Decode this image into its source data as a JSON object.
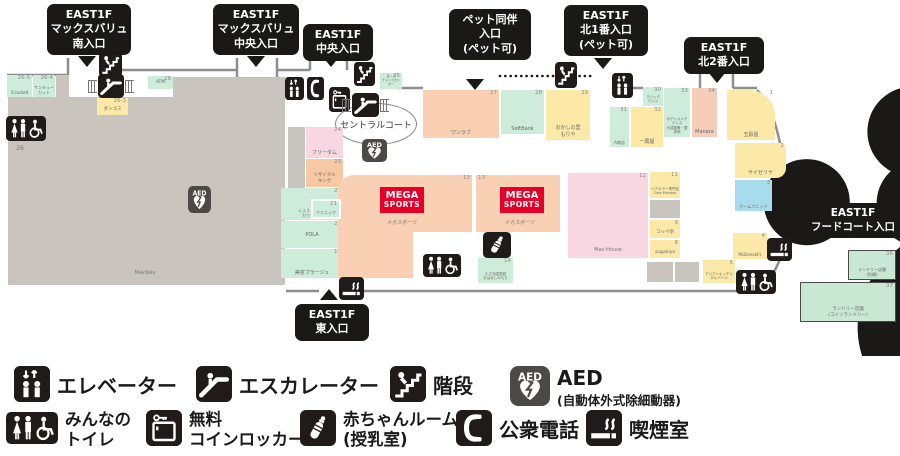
{
  "map": {
    "central_court": "セントラルコート",
    "logos": {
      "maxvalu": {
        "title": "MaxValu",
        "sub": "スーパーマーケット"
      },
      "mega": {
        "line1": "MEGA",
        "line2": "SPORTS"
      },
      "machouse": "Mac-House"
    },
    "entrances": [
      {
        "lines": [
          "EAST1F",
          "マックスバリュ",
          "南入口"
        ],
        "x": 47,
        "y": 4,
        "w": 84,
        "arrow": {
          "d": "down",
          "x": 78,
          "y": 56
        }
      },
      {
        "lines": [
          "EAST1F",
          "マックスバリュ",
          "中央入口"
        ],
        "x": 213,
        "y": 4,
        "w": 86,
        "arrow": {
          "d": "down",
          "x": 247,
          "y": 56
        }
      },
      {
        "lines": [
          "EAST1F",
          "中央入口"
        ],
        "x": 303,
        "y": 24,
        "w": 70,
        "arrow": {
          "d": "down",
          "x": 322,
          "y": 56
        }
      },
      {
        "lines": [
          "ペット同伴",
          "入口",
          "(ペット可)"
        ],
        "x": 449,
        "y": 9,
        "w": 82,
        "arrow": {
          "d": "down",
          "x": 466,
          "y": 79
        }
      },
      {
        "lines": [
          "EAST1F",
          "北1番入口",
          "(ペット可)"
        ],
        "x": 564,
        "y": 5,
        "w": 84,
        "arrow": {
          "d": "down",
          "x": 594,
          "y": 58
        }
      },
      {
        "lines": [
          "EAST1F",
          "北2番入口"
        ],
        "x": 684,
        "y": 37,
        "w": 80,
        "arrow": {
          "d": "down",
          "x": 708,
          "y": 72
        }
      },
      {
        "lines": [
          "EAST1F",
          "フードコート入口"
        ],
        "x": 806,
        "y": 203,
        "w": 94,
        "fs": 10.5,
        "arrow": {
          "d": "left",
          "x": 793,
          "y": 215
        }
      },
      {
        "lines": [
          "EAST1F",
          "東入口"
        ],
        "x": 295,
        "y": 304,
        "w": 74,
        "arrow": {
          "d": "up",
          "x": 320,
          "y": 289
        }
      }
    ],
    "shops": [
      {
        "x": 8,
        "y": 97,
        "w": 277,
        "h": 188,
        "c": "#cac4be"
      },
      {
        "x": 173,
        "y": 77,
        "w": 112,
        "h": 20,
        "c": "#cac4be"
      },
      {
        "x": 288,
        "y": 127,
        "w": 17,
        "h": 61,
        "c": "#cac4be"
      },
      {
        "x": 7,
        "y": 75,
        "w": 25,
        "h": 22,
        "c": "#cdecd9",
        "num": "26-5",
        "name": "iCracked",
        "fs": 4
      },
      {
        "x": 33,
        "y": 75,
        "w": 22,
        "h": 22,
        "c": "#cdecd9",
        "num": "26-4",
        "name": "サンキュー\nカット",
        "fs": 4
      },
      {
        "x": 56,
        "y": 75,
        "w": 13,
        "h": 25,
        "c": "#cac4be"
      },
      {
        "x": 97,
        "y": 98,
        "w": 31,
        "h": 17,
        "c": "#fce9a8",
        "num": "26-3",
        "name": "ダンゴス",
        "fs": 4.5
      },
      {
        "x": 148,
        "y": 76,
        "w": 25,
        "h": 13,
        "c": "#cdecd9",
        "num": "26",
        "name": "ATM",
        "cen": true,
        "fs": 4.5
      },
      {
        "x": 306,
        "y": 127,
        "w": 37,
        "h": 31,
        "c": "#f8d7e3",
        "num": "24",
        "name": "フリーダム"
      },
      {
        "x": 306,
        "y": 159,
        "w": 37,
        "h": 28,
        "c": "#f7c8a2",
        "num": "23",
        "name": "リサイクル\nキング",
        "fs": 4.5
      },
      {
        "x": 281,
        "y": 188,
        "w": 62,
        "h": 32,
        "c": "#cdecd9",
        "num": "22",
        "name": "くふうイエナカ\nカウンター",
        "fs": 4
      },
      {
        "x": 311,
        "y": 199,
        "w": 30,
        "h": 20,
        "c": "#cdecd9",
        "num": "21",
        "name": "クリニック",
        "fs": 4,
        "inset": true
      },
      {
        "x": 281,
        "y": 221,
        "w": 62,
        "h": 27,
        "c": "#cdecd9",
        "num": "20",
        "name": "POLA",
        "cen": true
      },
      {
        "x": 281,
        "y": 249,
        "w": 62,
        "h": 29,
        "c": "#cdecd9",
        "num": "19",
        "name": "美容プラージュ"
      },
      {
        "x": 423,
        "y": 90,
        "w": 76,
        "h": 48,
        "c": "#f9d0b4",
        "num": "27",
        "name": "ワンラブ"
      },
      {
        "x": 501,
        "y": 90,
        "w": 43,
        "h": 44,
        "c": "#cdecd9",
        "num": "28",
        "name": "SoftBank"
      },
      {
        "x": 546,
        "y": 90,
        "w": 44,
        "h": 50,
        "c": "#fce9a8",
        "num": "29",
        "name": "おかしの里\nもりや"
      },
      {
        "x": 643,
        "y": 87,
        "w": 20,
        "h": 19,
        "c": "#cdecd9",
        "num": "30",
        "name": "マジック\nミシン",
        "fs": 3.5
      },
      {
        "x": 610,
        "y": 107,
        "w": 19,
        "h": 40,
        "c": "#cdecd9",
        "num": "31",
        "name": "A商店",
        "fs": 4
      },
      {
        "x": 631,
        "y": 107,
        "w": 32,
        "h": 40,
        "c": "#fce9a8",
        "num": "32",
        "name": "一蔵屋"
      },
      {
        "x": 664,
        "y": 88,
        "w": 26,
        "h": 49,
        "c": "#cdecd9",
        "num": "33",
        "name": "ボディメンテナンス\n大成整骨・整体院",
        "fs": 3.5
      },
      {
        "x": 692,
        "y": 88,
        "w": 25,
        "h": 49,
        "c": "#f5cdb9",
        "num": "34",
        "name": "Manara"
      },
      {
        "x": 727,
        "y": 90,
        "w": 48,
        "h": 50,
        "c": "#fce9a8",
        "num": "1",
        "name": "五穀屋",
        "r": "0 26px 0 0"
      },
      {
        "x": 735,
        "y": 143,
        "w": 51,
        "h": 35,
        "c": "#fce9a8",
        "num": "2",
        "name": "サイゼリヤ",
        "r": "0 6px 10px 0"
      },
      {
        "x": 735,
        "y": 180,
        "w": 37,
        "h": 31,
        "c": "#a8dcec",
        "num": "3",
        "name": "ゲームパニック",
        "fs": 4
      },
      {
        "x": 733,
        "y": 233,
        "w": 34,
        "h": 26,
        "c": "#fce9a8",
        "num": "4",
        "name": "McDonald's",
        "fs": 4
      },
      {
        "x": 703,
        "y": 260,
        "w": 32,
        "h": 23,
        "c": "#fce9a8",
        "num": "5",
        "name": "アジアンキッチン\nダルバール",
        "fs": 3.5
      },
      {
        "x": 650,
        "y": 172,
        "w": 30,
        "h": 26,
        "c": "#fce9a8",
        "num": "11",
        "name": "ヘアカラー専門店\nCinq Minutes",
        "fs": 3.5
      },
      {
        "x": 650,
        "y": 200,
        "w": 30,
        "h": 18,
        "c": "#cac4be"
      },
      {
        "x": 650,
        "y": 220,
        "w": 30,
        "h": 18,
        "c": "#fce9a8",
        "num": "9",
        "name": "コッペ亭",
        "fs": 4.5
      },
      {
        "x": 650,
        "y": 240,
        "w": 30,
        "h": 18,
        "c": "#fce9a8",
        "num": "8",
        "name": "sugakiya",
        "fs": 4.5
      },
      {
        "x": 647,
        "y": 262,
        "w": 26,
        "h": 20,
        "c": "#cac4be"
      },
      {
        "x": 675,
        "y": 262,
        "w": 24,
        "h": 20,
        "c": "#cac4be"
      },
      {
        "x": 338,
        "y": 175,
        "w": 134,
        "h": 57,
        "c": "#f9d0b4",
        "num": "13",
        "r": "16px 0 0 0"
      },
      {
        "x": 338,
        "y": 232,
        "w": 75,
        "h": 46,
        "c": "#f9d0b4"
      },
      {
        "x": 476,
        "y": 175,
        "w": 84,
        "h": 57,
        "c": "#f9d0b4",
        "num": "13",
        "numTL": true
      },
      {
        "x": 568,
        "y": 173,
        "w": 80,
        "h": 85,
        "c": "#f8d7e3",
        "num": "12"
      },
      {
        "x": 478,
        "y": 258,
        "w": 35,
        "h": 25,
        "c": "#cdecd9",
        "num": "14",
        "name": "小さな図書館\nおはなしのもり",
        "fs": 3.5
      },
      {
        "x": 848,
        "y": 250,
        "w": 48,
        "h": 30,
        "c": "#c9e8d4",
        "num": "36",
        "name": "ランドリー店舗\n(別棟)",
        "fs": 4,
        "bd": true
      },
      {
        "x": 800,
        "y": 282,
        "w": 96,
        "h": 40,
        "c": "#c9e8d4",
        "num": "37",
        "name": "ランドリー店舗\n(コインランドリー)",
        "fs": 4.5,
        "bd": true
      },
      {
        "x": 380,
        "y": 73,
        "w": 22,
        "h": 16,
        "c": "#cdecd9",
        "num": "35",
        "name": "宝くじ\nチャンスセンター",
        "fs": 3
      }
    ],
    "texts": [
      {
        "t": "メガスポーツ",
        "x": 372,
        "y": 221,
        "w": 60,
        "s": 5
      },
      {
        "t": "メガスポーツ",
        "x": 490,
        "y": 221,
        "w": 60,
        "s": 5
      },
      {
        "t": "Mac-House",
        "x": 583,
        "y": 248,
        "w": 50,
        "s": 5
      },
      {
        "t": "MaxValu",
        "x": 125,
        "y": 271,
        "w": 40,
        "s": 5
      },
      {
        "t": "26",
        "x": 10,
        "y": 146,
        "w": 20,
        "s": 6
      }
    ],
    "icons": [
      {
        "t": "stairs",
        "x": 99,
        "y": 52,
        "w": 23,
        "h": 25
      },
      {
        "t": "esc",
        "x": 98,
        "y": 74,
        "w": 26,
        "h": 24,
        "comb": true
      },
      {
        "t": "stairs",
        "x": 354,
        "y": 62,
        "w": 21,
        "h": 24
      },
      {
        "t": "elev",
        "x": 285,
        "y": 77,
        "w": 19,
        "h": 23
      },
      {
        "t": "phone",
        "x": 307,
        "y": 77,
        "w": 17,
        "h": 23
      },
      {
        "t": "locker",
        "x": 329,
        "y": 87,
        "w": 21,
        "h": 25
      },
      {
        "t": "esc",
        "x": 352,
        "y": 93,
        "w": 27,
        "h": 24,
        "comb": true
      },
      {
        "t": "aed",
        "x": 362,
        "y": 139,
        "w": 25,
        "h": 23
      },
      {
        "t": "aed",
        "x": 188,
        "y": 186,
        "w": 23,
        "h": 27
      },
      {
        "t": "toilet",
        "x": 6,
        "y": 116,
        "w": 40,
        "h": 25
      },
      {
        "t": "toilet",
        "x": 423,
        "y": 254,
        "w": 38,
        "h": 23
      },
      {
        "t": "toilet",
        "x": 736,
        "y": 270,
        "w": 40,
        "h": 24
      },
      {
        "t": "baby",
        "x": 483,
        "y": 232,
        "w": 28,
        "h": 26
      },
      {
        "t": "smoke",
        "x": 339,
        "y": 277,
        "w": 25,
        "h": 23
      },
      {
        "t": "smoke",
        "x": 767,
        "y": 238,
        "w": 25,
        "h": 23
      },
      {
        "t": "stairs",
        "x": 555,
        "y": 62,
        "w": 22,
        "h": 26
      },
      {
        "t": "elev",
        "x": 612,
        "y": 73,
        "w": 21,
        "h": 25
      }
    ]
  },
  "legend": {
    "rows": [
      [
        {
          "icon": "elev",
          "x": 14,
          "label": "エレベーター"
        },
        {
          "icon": "esc",
          "x": 196,
          "label": "エスカレーター"
        },
        {
          "icon": "stairs",
          "x": 390,
          "label": "階段"
        },
        {
          "icon": "aed",
          "x": 510,
          "label": "AED",
          "sub": "(自動体外式除細動器)"
        }
      ],
      [
        {
          "icon": "toilet",
          "x": 6,
          "label": "みんなの\nトイレ"
        },
        {
          "icon": "locker",
          "x": 146,
          "label": "無料\nコインロッカー"
        },
        {
          "icon": "baby",
          "x": 300,
          "label": "赤ちゃんルーム\n(授乳室)"
        },
        {
          "icon": "phone",
          "x": 456,
          "label": "公衆電話"
        },
        {
          "icon": "smoke",
          "x": 586,
          "label": "喫煙室"
        }
      ]
    ]
  }
}
